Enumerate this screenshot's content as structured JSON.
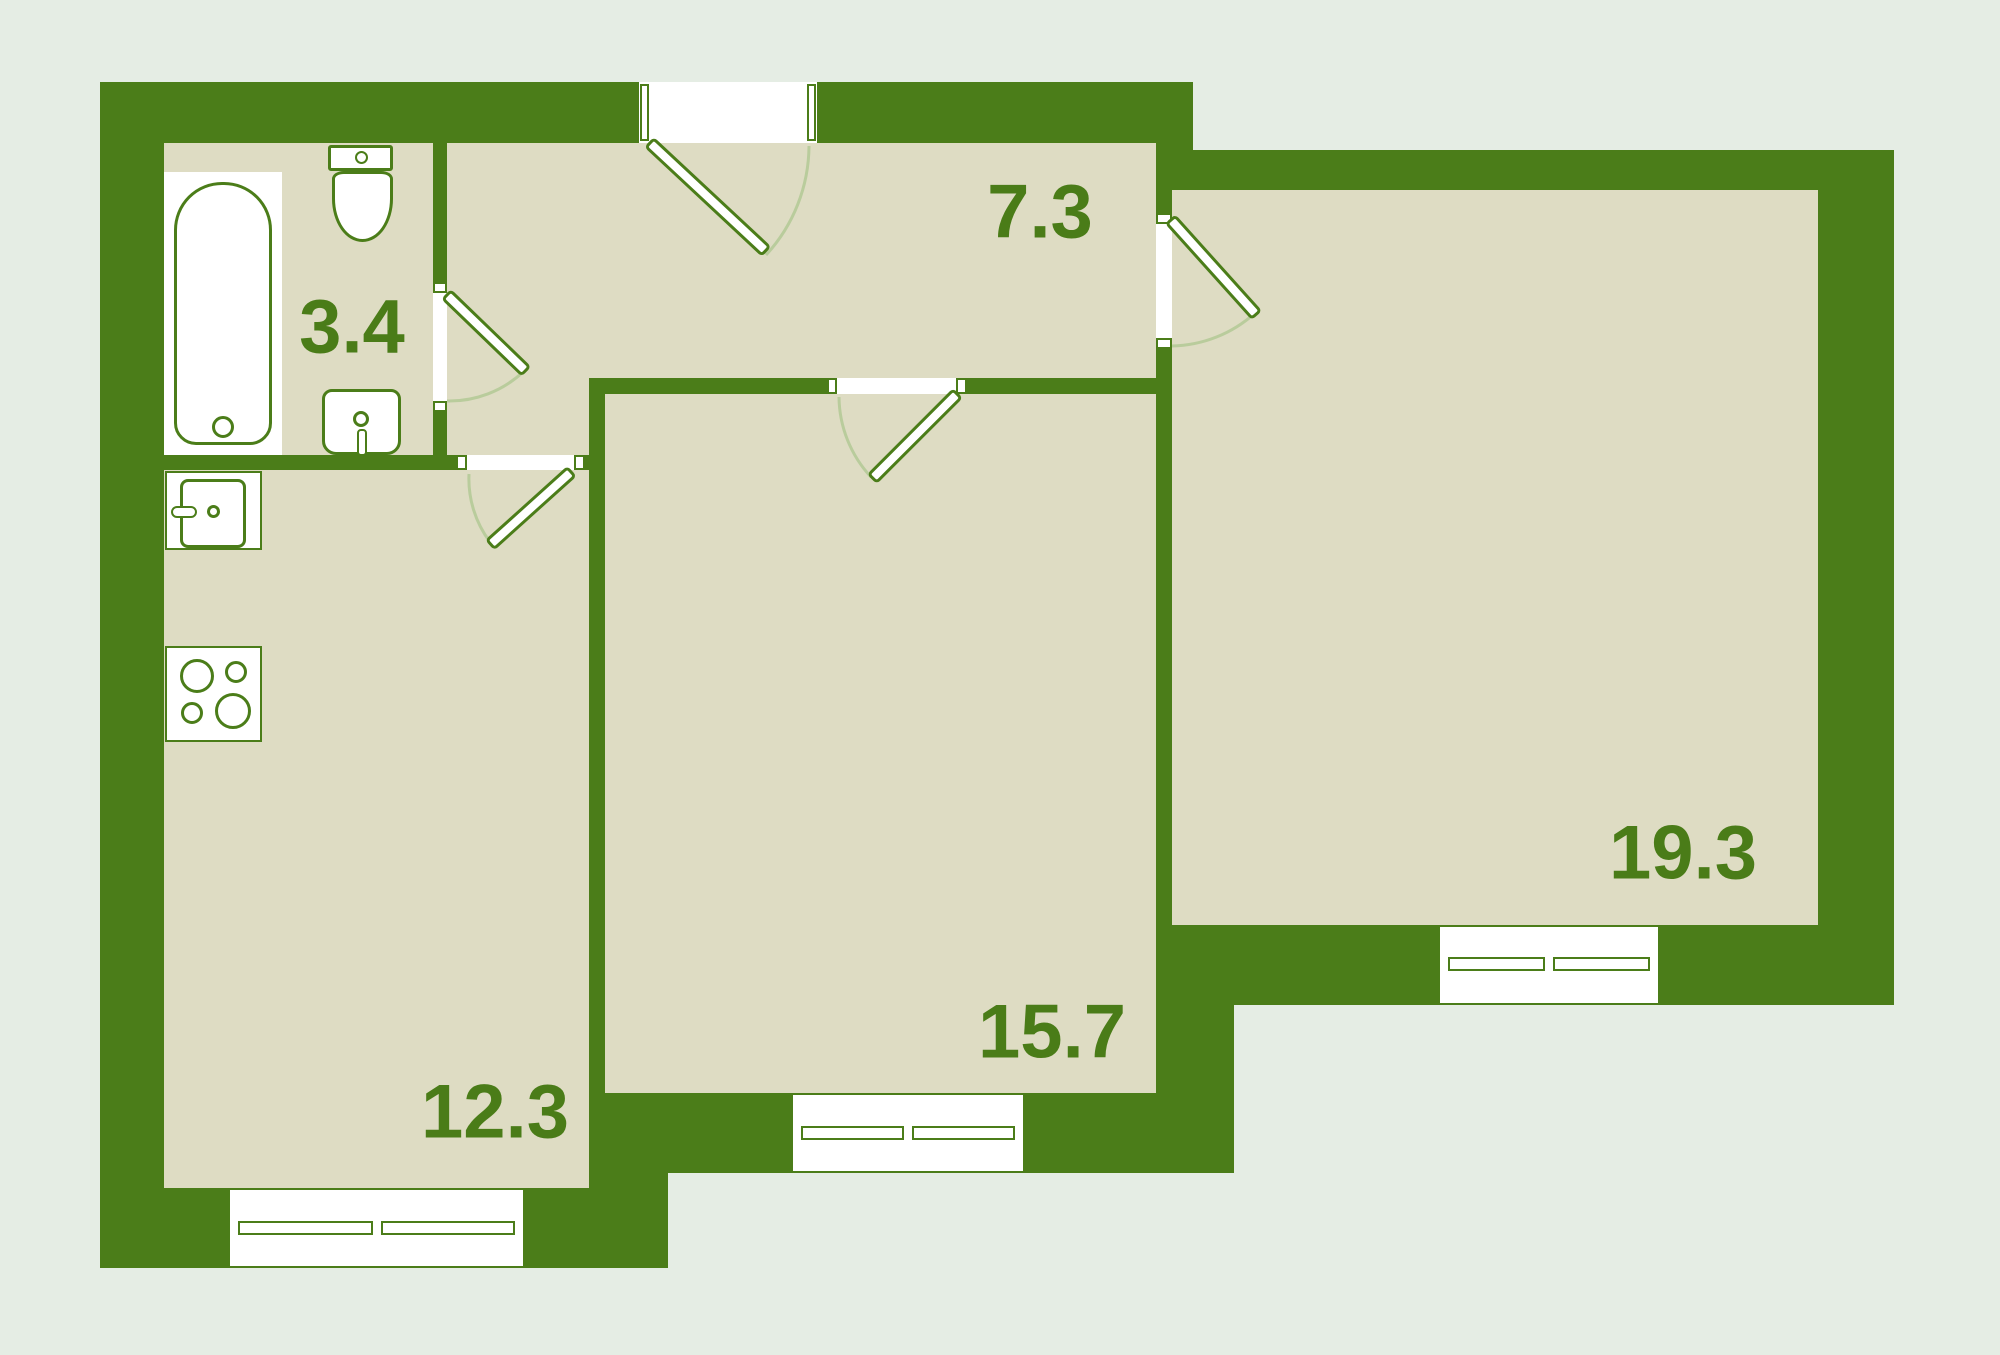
{
  "plan": {
    "type": "apartment-floor-plan",
    "rooms": [
      {
        "name": "bathroom",
        "area_label": "3.4"
      },
      {
        "name": "hallway",
        "area_label": "7.3"
      },
      {
        "name": "kitchen",
        "area_label": "12.3"
      },
      {
        "name": "bedroom",
        "area_label": "15.7"
      },
      {
        "name": "living-room",
        "area_label": "19.3"
      }
    ],
    "fixtures": [
      "bathtub",
      "toilet",
      "washbasin",
      "kitchen-sink",
      "stove"
    ],
    "openings": {
      "entrance_doors": 1,
      "interior_doors": 4,
      "windows": 3
    },
    "colors": {
      "wall": "#4b7d19",
      "floor": "#dedcc3",
      "background": "#e5ede4",
      "label_text": "#4a7c18",
      "swing_arc": "#b9cc9c",
      "fixture_fill": "#ffffff"
    }
  }
}
